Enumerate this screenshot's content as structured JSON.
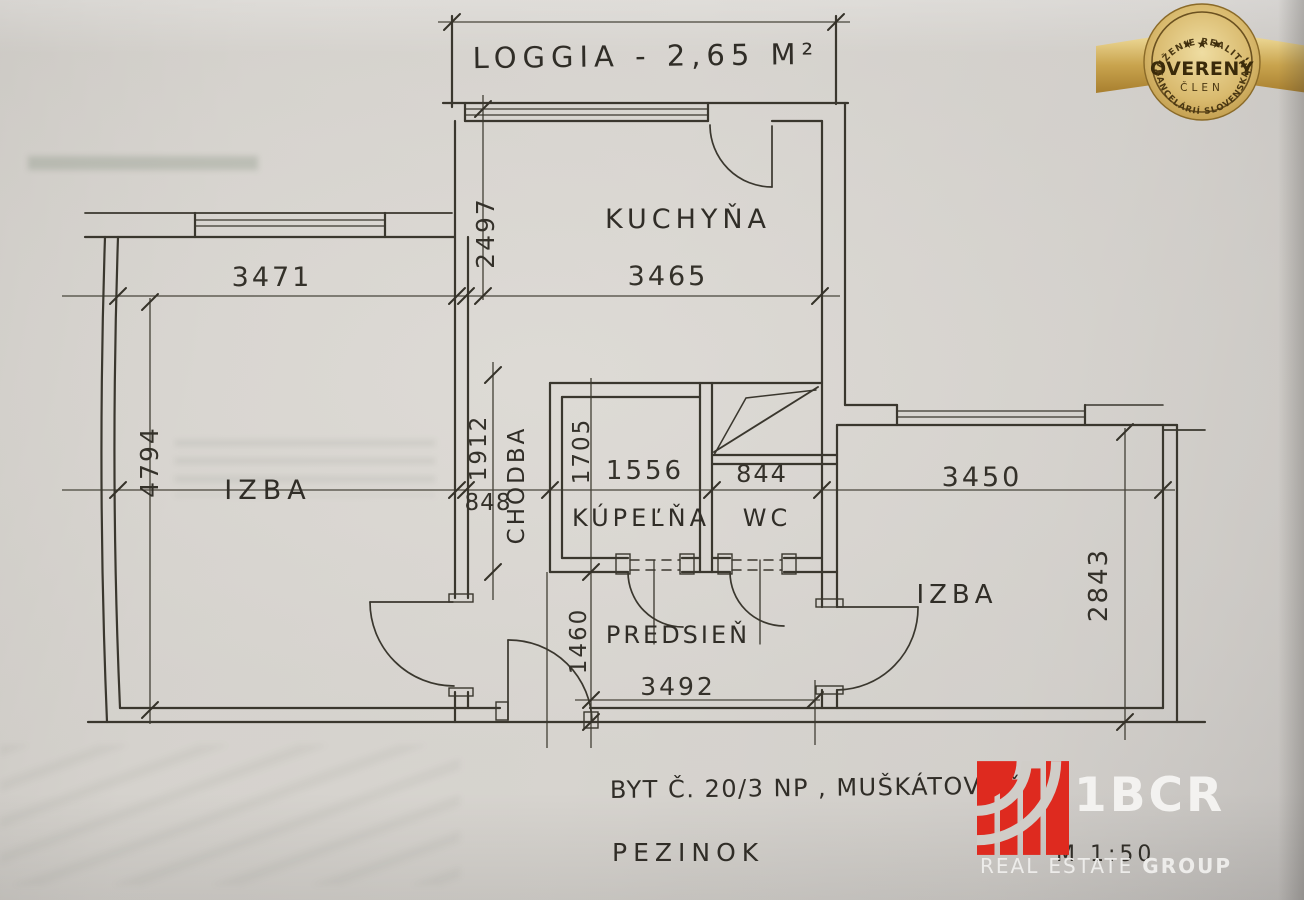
{
  "plan": {
    "room_labels": {
      "loggia": "LOGGIA - 2,65 M²",
      "kitchen": "KUCHYŇA",
      "room_left": "IZBA",
      "room_right": "IZBA",
      "bathroom": "KÚPEĽŇA",
      "wc": "WC",
      "hall": "PREDSIEŇ",
      "corridor": "CHODBA"
    },
    "dimensions": {
      "room_left_width": "3471",
      "kitchen_width": "3465",
      "kitchen_depth": "2497",
      "room_left_depth": "4794",
      "corridor_length": "1912",
      "corridor_width": "848",
      "bathroom_depth": "1705",
      "bathroom_width": "1556",
      "wc_width": "844",
      "room_right_width": "3450",
      "room_right_depth": "2843",
      "hall_depth": "1460",
      "hall_width": "3492"
    },
    "notes": {
      "address_line": "BYT Č. 20/3 NP , MUŠKÁTOVÁ č",
      "city": "PEZINOK",
      "scale": "M  1:50"
    }
  },
  "badge": {
    "arc_top": "ZDRUŽENIE REALITNÝCH",
    "stars": "★ ★ ★",
    "title": "OVERENÝ",
    "subtitle": "ČLEN",
    "arc_bottom": "KANCELÁRIÍ SLOVENSKA",
    "gold_color": "#c9a84f"
  },
  "brand": {
    "name": "1BCR",
    "tagline_1": "REAL",
    "tagline_2": "ESTATE",
    "tagline_3": "GROUP",
    "red_color": "#de2a1f"
  },
  "colors": {
    "ink": "#35322b",
    "paper": "#d2cfca"
  }
}
